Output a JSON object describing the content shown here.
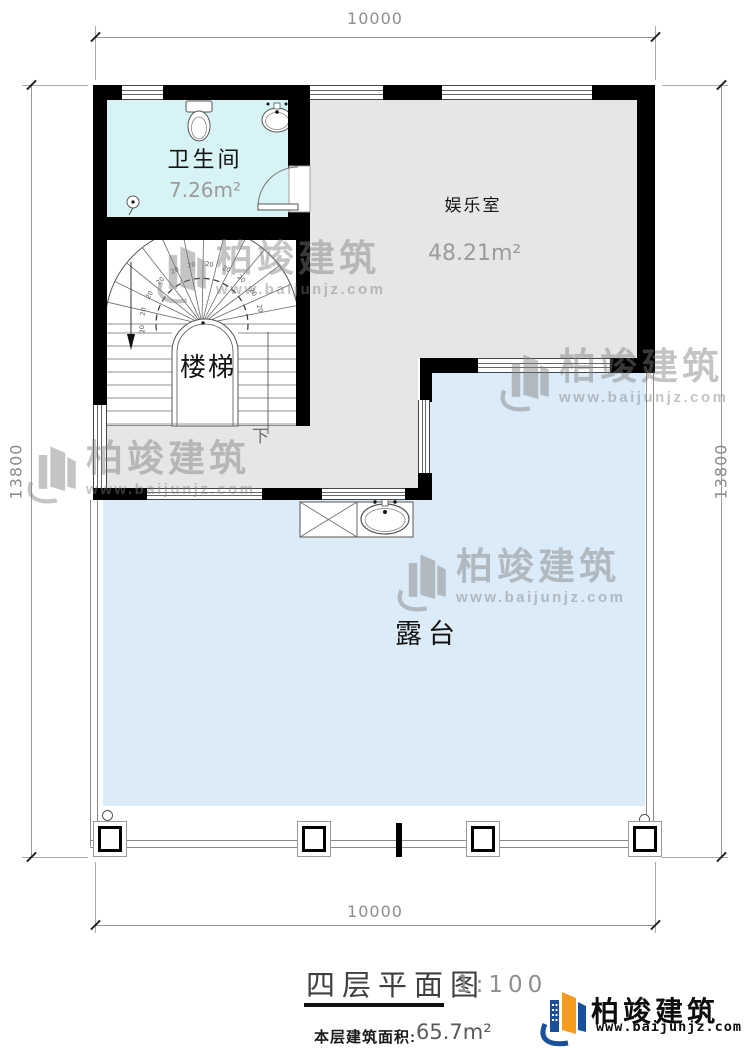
{
  "plan": {
    "title": "四层平面图",
    "scale": "1:100",
    "area_label": "本层建筑面积:",
    "area_value": "65.7m²"
  },
  "rooms": [
    {
      "name": "卫生间",
      "area": "7.26m²"
    },
    {
      "name": "娱乐室",
      "area": "48.21m²"
    },
    {
      "name": "楼梯"
    },
    {
      "name": "露台"
    }
  ],
  "stairs": {
    "direction_label": "下",
    "tread_label": "20"
  },
  "dimensions": {
    "top": "10000",
    "bottom": "10000",
    "left": "13800",
    "right": "13800"
  },
  "watermark": {
    "brand": "柏竣建筑",
    "url": "www.baijunjz.com"
  },
  "brand_logo": {
    "name": "柏竣建筑",
    "url": "www.baijunjz.com"
  },
  "colors": {
    "bathroom_fill": "#d8f3f6",
    "room_fill": "#e6e6e6",
    "terrace_fill": "#dcebf8",
    "wall": "#000000",
    "watermark_gray": "#d6d6d6",
    "logo_blue": "#1a4f9c",
    "logo_orange": "#f59b1e"
  }
}
